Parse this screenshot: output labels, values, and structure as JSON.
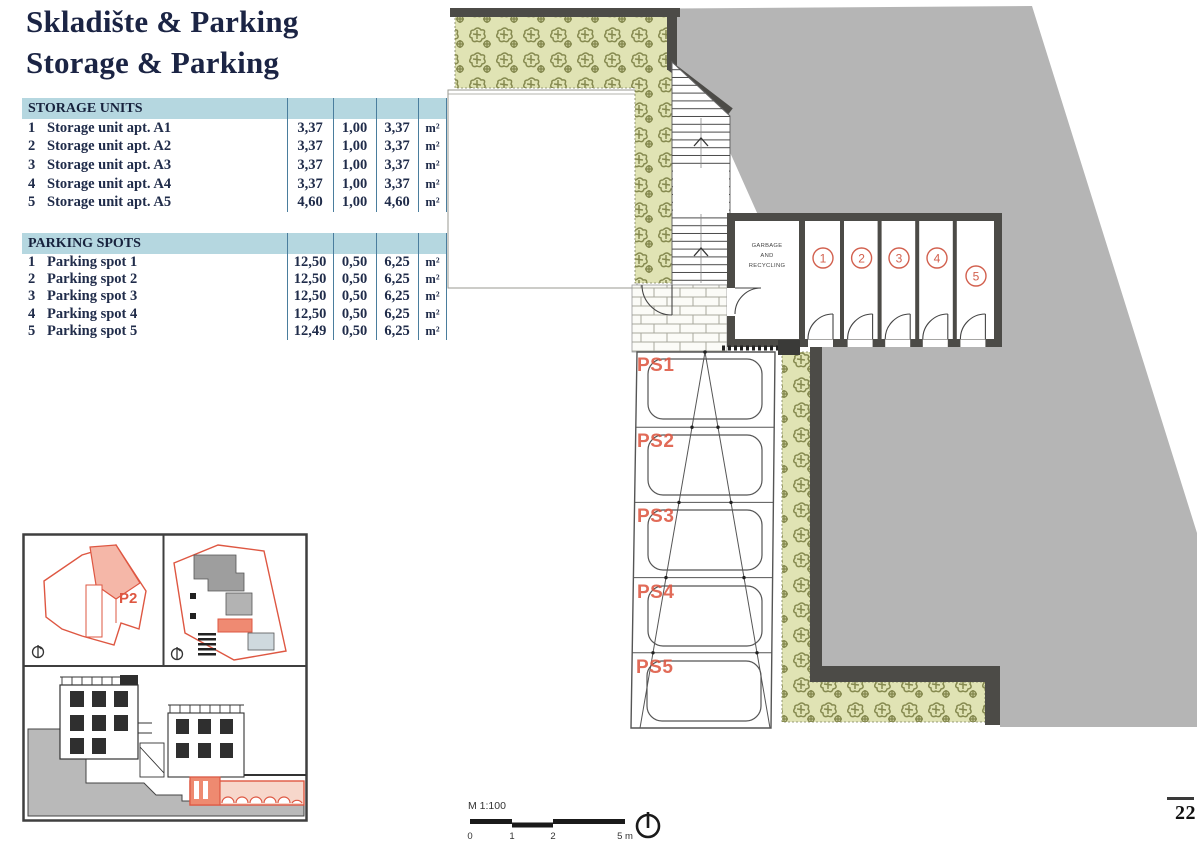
{
  "page": {
    "title_line1": "Skladište & Parking",
    "title_line2": "Storage & Parking",
    "page_number": "22"
  },
  "storage_table": {
    "header": "STORAGE UNITS",
    "rows": [
      {
        "num": "1",
        "name": "Storage unit apt. A1",
        "area": "3,37",
        "coef": "1,00",
        "total": "3,37",
        "unit": "m²"
      },
      {
        "num": "2",
        "name": "Storage unit apt. A2",
        "area": "3,37",
        "coef": "1,00",
        "total": "3,37",
        "unit": "m²"
      },
      {
        "num": "3",
        "name": "Storage unit apt. A3",
        "area": "3,37",
        "coef": "1,00",
        "total": "3,37",
        "unit": "m²"
      },
      {
        "num": "4",
        "name": "Storage unit apt. A4",
        "area": "3,37",
        "coef": "1,00",
        "total": "3,37",
        "unit": "m²"
      },
      {
        "num": "5",
        "name": "Storage unit apt. A5",
        "area": "4,60",
        "coef": "1,00",
        "total": "4,60",
        "unit": "m²"
      }
    ]
  },
  "parking_table": {
    "header": "PARKING SPOTS",
    "rows": [
      {
        "num": "1",
        "name": "Parking spot 1",
        "area": "12,50",
        "coef": "0,50",
        "total": "6,25",
        "unit": "m²"
      },
      {
        "num": "2",
        "name": "Parking spot 2",
        "area": "12,50",
        "coef": "0,50",
        "total": "6,25",
        "unit": "m²"
      },
      {
        "num": "3",
        "name": "Parking spot 3",
        "area": "12,50",
        "coef": "0,50",
        "total": "6,25",
        "unit": "m²"
      },
      {
        "num": "4",
        "name": "Parking spot 4",
        "area": "12,50",
        "coef": "0,50",
        "total": "6,25",
        "unit": "m²"
      },
      {
        "num": "5",
        "name": "Parking spot 5",
        "area": "12,49",
        "coef": "0,50",
        "total": "6,25",
        "unit": "m²"
      }
    ]
  },
  "floor_plan": {
    "garbage_room_lines": [
      "GARBAGE",
      "AND",
      "RECYCLING"
    ],
    "unit_numbers": [
      "1",
      "2",
      "3",
      "4",
      "5"
    ],
    "parking_spot_labels": [
      "PS1",
      "PS2",
      "PS3",
      "PS4",
      "PS5"
    ]
  },
  "inset": {
    "parcel_label": "P2"
  },
  "scale_bar": {
    "label": "M 1:100",
    "ticks": [
      "0",
      "1",
      "2",
      "5 m"
    ]
  },
  "colors": {
    "table_header_bg": "#b5d7e0",
    "table_line": "#4a7d9d",
    "text_navy": "#1f2b4a",
    "site_gray": "#b5b5b5",
    "wall_dark": "#4c4b47",
    "greenery": "#e0e3b4",
    "greenery_plant": "#8a8e54",
    "accent_orange": "#de5742"
  }
}
